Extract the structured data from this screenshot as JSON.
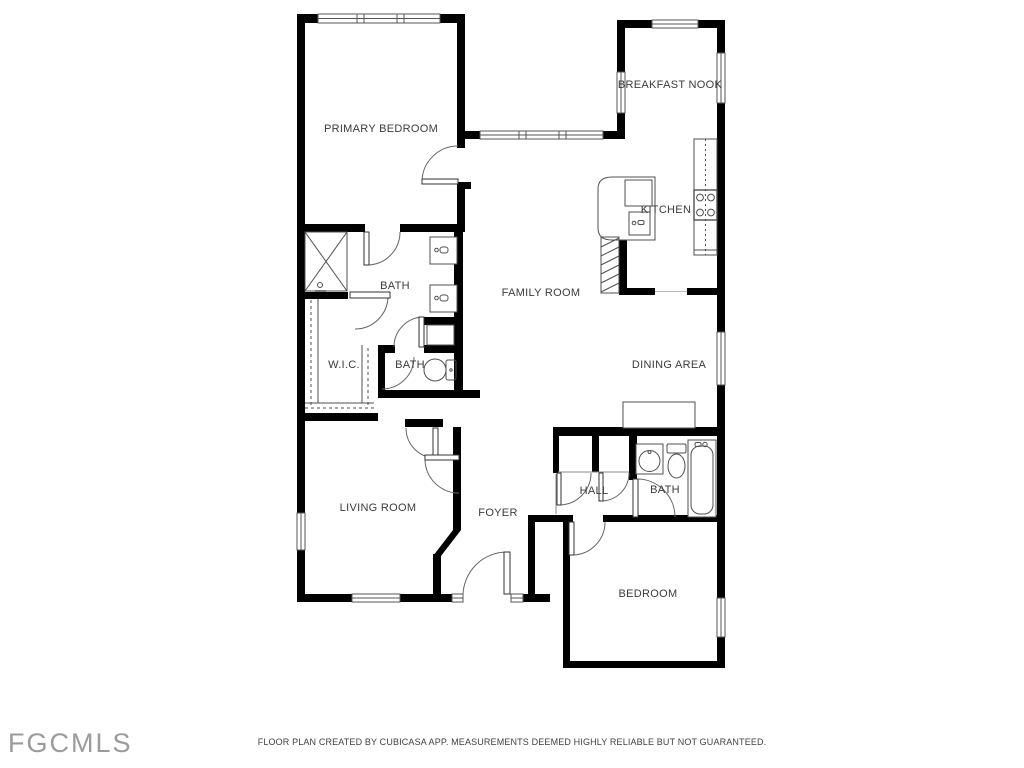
{
  "watermark": "FGCMLS",
  "footer": {
    "disclaimer": "FLOOR PLAN CREATED BY CUBICASA APP. MEASUREMENTS DEEMED HIGHLY RELIABLE BUT NOT GUARANTEED."
  },
  "floor_plan": {
    "rooms": [
      {
        "label": "PRIMARY BEDROOM"
      },
      {
        "label": "BREAKFAST NOOK"
      },
      {
        "label": "KITCHEN"
      },
      {
        "label": "BATH"
      },
      {
        "label": "W.I.C."
      },
      {
        "label": "BATH"
      },
      {
        "label": "FAMILY ROOM"
      },
      {
        "label": "DINING AREA"
      },
      {
        "label": "LIVING ROOM"
      },
      {
        "label": "FOYER"
      },
      {
        "label": "HALL"
      },
      {
        "label": "BATH"
      },
      {
        "label": "BEDROOM"
      }
    ],
    "colors": {
      "wall": "#000000",
      "thin_line": "#4f4f4f",
      "label_text": "#3b3b3b",
      "watermark_text": "#9b9b9b",
      "footer_text": "#3f3f3f"
    },
    "fixtures": [
      "shower",
      "shower-head",
      "vanity-sink",
      "vanity-sink",
      "toilet",
      "closet-shelves",
      "kitchen-island",
      "refrigerator",
      "island-sink",
      "counter",
      "stove",
      "stairs",
      "dining-cabinet",
      "hall-closet",
      "hall-closet",
      "bathroom-sink",
      "toilet",
      "bathtub"
    ]
  }
}
